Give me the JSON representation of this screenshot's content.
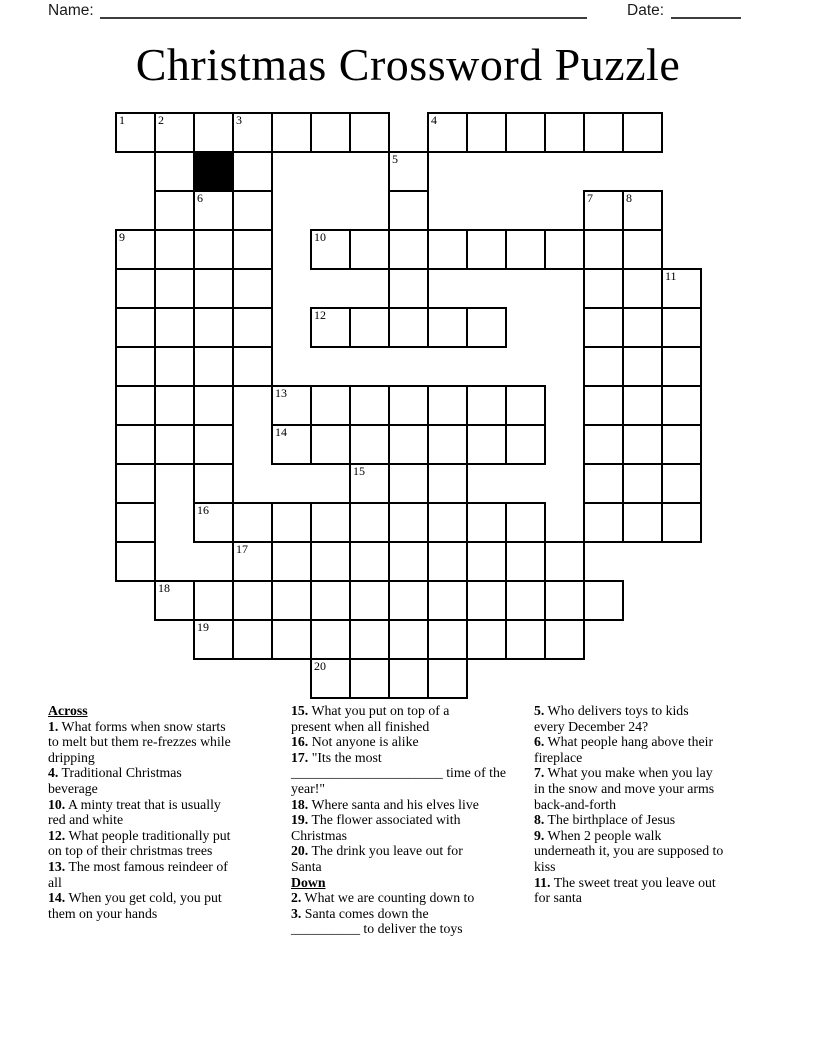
{
  "header": {
    "name_label": "Name:",
    "date_label": "Date:"
  },
  "title": "Christmas Crossword Puzzle",
  "grid": {
    "rows": 15,
    "cols": 15,
    "cell_px": 39,
    "origin": {
      "x": 115,
      "y": 112
    },
    "filled": {
      "0": [
        0,
        1,
        2,
        3,
        4,
        5,
        6,
        8,
        9,
        10,
        11,
        12,
        13
      ],
      "1": [
        1,
        2,
        3,
        7
      ],
      "2": [
        1,
        2,
        3,
        7,
        12,
        13
      ],
      "3": [
        0,
        1,
        2,
        3,
        5,
        6,
        7,
        8,
        9,
        10,
        11,
        12,
        13
      ],
      "4": [
        0,
        1,
        2,
        3,
        7,
        12,
        13,
        14
      ],
      "5": [
        0,
        1,
        2,
        3,
        5,
        6,
        7,
        8,
        9,
        12,
        13,
        14
      ],
      "6": [
        0,
        1,
        2,
        3,
        12,
        13,
        14
      ],
      "7": [
        0,
        1,
        2,
        4,
        5,
        6,
        7,
        8,
        9,
        10,
        12,
        13,
        14
      ],
      "8": [
        0,
        1,
        2,
        4,
        5,
        6,
        7,
        8,
        9,
        10,
        12,
        13,
        14
      ],
      "9": [
        0,
        2,
        6,
        7,
        8,
        12,
        13,
        14
      ],
      "10": [
        0,
        2,
        3,
        4,
        5,
        6,
        7,
        8,
        9,
        10,
        12,
        13,
        14
      ],
      "11": [
        0,
        3,
        4,
        5,
        6,
        7,
        8,
        9,
        10,
        11
      ],
      "12": [
        1,
        2,
        3,
        4,
        5,
        6,
        7,
        8,
        9,
        10,
        11,
        12
      ],
      "13": [
        2,
        3,
        4,
        5,
        6,
        7,
        8,
        9,
        10,
        11
      ],
      "14": [
        5,
        6,
        7,
        8
      ]
    },
    "black": [
      [
        1,
        2
      ]
    ],
    "numbers": [
      {
        "n": "1",
        "r": 0,
        "c": 0
      },
      {
        "n": "2",
        "r": 0,
        "c": 1
      },
      {
        "n": "3",
        "r": 0,
        "c": 3
      },
      {
        "n": "4",
        "r": 0,
        "c": 8
      },
      {
        "n": "5",
        "r": 1,
        "c": 7
      },
      {
        "n": "6",
        "r": 2,
        "c": 2
      },
      {
        "n": "7",
        "r": 2,
        "c": 12
      },
      {
        "n": "8",
        "r": 2,
        "c": 13
      },
      {
        "n": "9",
        "r": 3,
        "c": 0
      },
      {
        "n": "10",
        "r": 3,
        "c": 5
      },
      {
        "n": "11",
        "r": 4,
        "c": 14
      },
      {
        "n": "12",
        "r": 5,
        "c": 5
      },
      {
        "n": "13",
        "r": 7,
        "c": 4
      },
      {
        "n": "14",
        "r": 8,
        "c": 4
      },
      {
        "n": "15",
        "r": 9,
        "c": 6
      },
      {
        "n": "16",
        "r": 10,
        "c": 2
      },
      {
        "n": "17",
        "r": 11,
        "c": 3
      },
      {
        "n": "18",
        "r": 12,
        "c": 1
      },
      {
        "n": "19",
        "r": 13,
        "c": 2
      },
      {
        "n": "20",
        "r": 14,
        "c": 5
      }
    ]
  },
  "clue_columns": [
    {
      "left_px": 48,
      "sections": [
        {
          "header": "Across",
          "clues": [
            {
              "num": "1.",
              "text": "What forms when snow starts\nto melt but them re-frezzes while\ndripping"
            },
            {
              "num": "4.",
              "text": "Traditional Christmas\nbeverage"
            },
            {
              "num": "10.",
              "text": "A minty treat that is usually\nred and white"
            },
            {
              "num": "12.",
              "text": "What people traditionally put\non top of their christmas trees"
            },
            {
              "num": "13.",
              "text": "The most famous reindeer of\nall"
            },
            {
              "num": "14.",
              "text": "When you get cold, you put\nthem on your hands"
            }
          ]
        }
      ]
    },
    {
      "left_px": 291,
      "sections": [
        {
          "header": "",
          "clues": [
            {
              "num": "15.",
              "text": "What you put on top of a\npresent when all finished"
            },
            {
              "num": "16.",
              "text": "Not anyone is alike"
            },
            {
              "num": "17.",
              "text": "\"Its the most\n______________________ time of the\nyear!\""
            },
            {
              "num": "18.",
              "text": "Where santa and his elves live"
            },
            {
              "num": "19.",
              "text": "The flower associated with\nChristmas"
            },
            {
              "num": "20.",
              "text": "The drink you leave out for\nSanta"
            }
          ]
        },
        {
          "header": "Down",
          "clues": [
            {
              "num": "2.",
              "text": "What we are counting down to"
            },
            {
              "num": "3.",
              "text": "Santa comes down the\n__________ to deliver the toys"
            }
          ]
        }
      ]
    },
    {
      "left_px": 534,
      "sections": [
        {
          "header": "",
          "clues": [
            {
              "num": "5.",
              "text": "Who delivers toys to kids\nevery December 24?"
            },
            {
              "num": "6.",
              "text": "What people hang above their\nfireplace"
            },
            {
              "num": "7.",
              "text": "What you make when you lay\nin the snow and move your arms\nback-and-forth"
            },
            {
              "num": "8.",
              "text": "The birthplace of Jesus"
            },
            {
              "num": "9.",
              "text": "When 2 people walk\nunderneath it, you are supposed to\nkiss"
            },
            {
              "num": "11.",
              "text": "The sweet treat you leave out\nfor santa"
            }
          ]
        }
      ]
    }
  ]
}
